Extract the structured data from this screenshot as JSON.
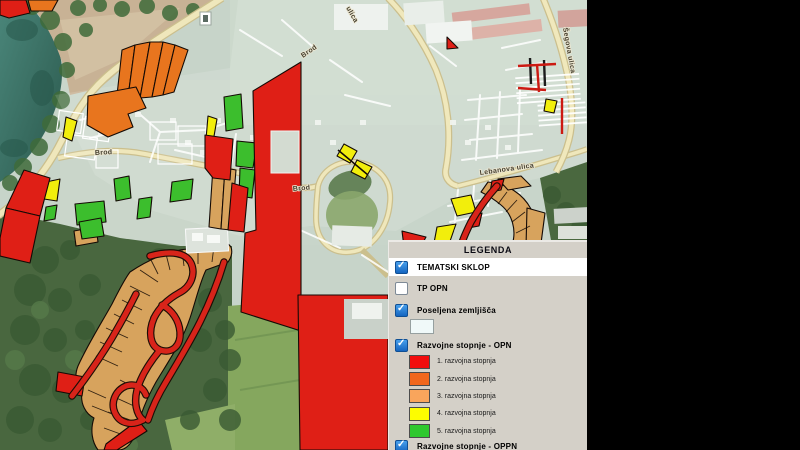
{
  "map": {
    "type": "aerial-gis-viewer",
    "labels": {
      "brod_top": "Brod",
      "brod_west": "Brod",
      "brod_center": "Brod",
      "segova_ulica": "Šegova ulica",
      "lebanova_ulica": "Lebanova ulica",
      "ulica_fragment": "ulica"
    }
  },
  "legend": {
    "title": "LEGENDA",
    "items": [
      {
        "label": "TEMATSKI SKLOP",
        "checked": true,
        "highlighted": true
      },
      {
        "label": "TP OPN",
        "checked": false
      },
      {
        "label": "Poseljena zemljišča",
        "checked": true,
        "swatch": "#f0f9f9"
      },
      {
        "label": "Razvojne stopnje - OPN",
        "checked": true,
        "stages": [
          {
            "label": "1. razvojna stopnja",
            "color": "#f20d0d"
          },
          {
            "label": "2. razvojna stopnja",
            "color": "#f1671d"
          },
          {
            "label": "3. razvojna stopnja",
            "color": "#f9a55c"
          },
          {
            "label": "4. razvojna stopnja",
            "color": "#fdfd00"
          },
          {
            "label": "5. razvojna stopnja",
            "color": "#2ec82e"
          }
        ]
      },
      {
        "label": "Razvojne stopnje - OPPN",
        "checked": true
      }
    ]
  }
}
